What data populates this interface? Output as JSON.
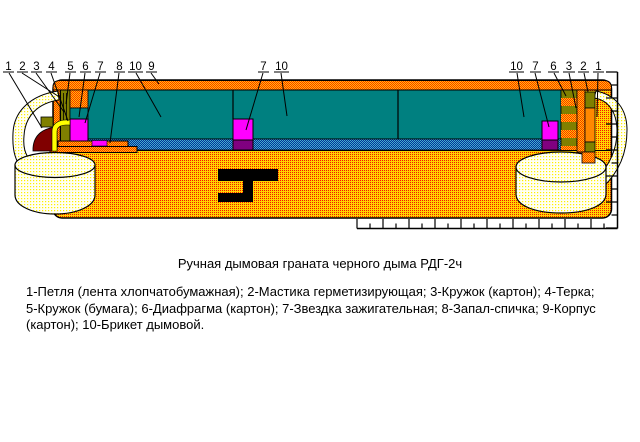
{
  "title": "Ручная дымовая граната черного дыма РДГ-2ч",
  "caption": "1-Петля (лента хлопчатобумажная); 2-Мастика герметизирующая; 3-Кружок (картон); 4-Терка;\n5-Кружок (бумага); 6-Диафрагма (картон); 7-Звездка зажигательная; 8-Запал-спичка; 9-Корпус\n(картон); 10-Брикет дымовой.",
  "labels": {
    "left": [
      "1",
      "2",
      "3",
      "4",
      "5",
      "6",
      "7",
      "8",
      "10",
      "9"
    ],
    "middle": [
      "7",
      "10"
    ],
    "right": [
      "10",
      "7",
      "6",
      "3",
      "2",
      "1"
    ]
  },
  "colors": {
    "briquette_teal": "#008080",
    "star_magenta": "#FF00FF",
    "star_purple": "#800080",
    "diaphragm_olive": "#808000",
    "seal_darkred": "#800000",
    "fuse_yellow": "#FFFF00",
    "cap_orange_solid": "#FF8800",
    "body_yellow": "#FFD400",
    "body_dot_red": "#F21800",
    "band_orange": "#FFC800",
    "band_dot_red": "#FF2A00",
    "layer_blue": "#003399",
    "layer_blue_dot": "#44AACC",
    "tape_cream": "#FFFFF5",
    "tape_dot_yellow": "#FFF000",
    "outline": "#000000"
  }
}
